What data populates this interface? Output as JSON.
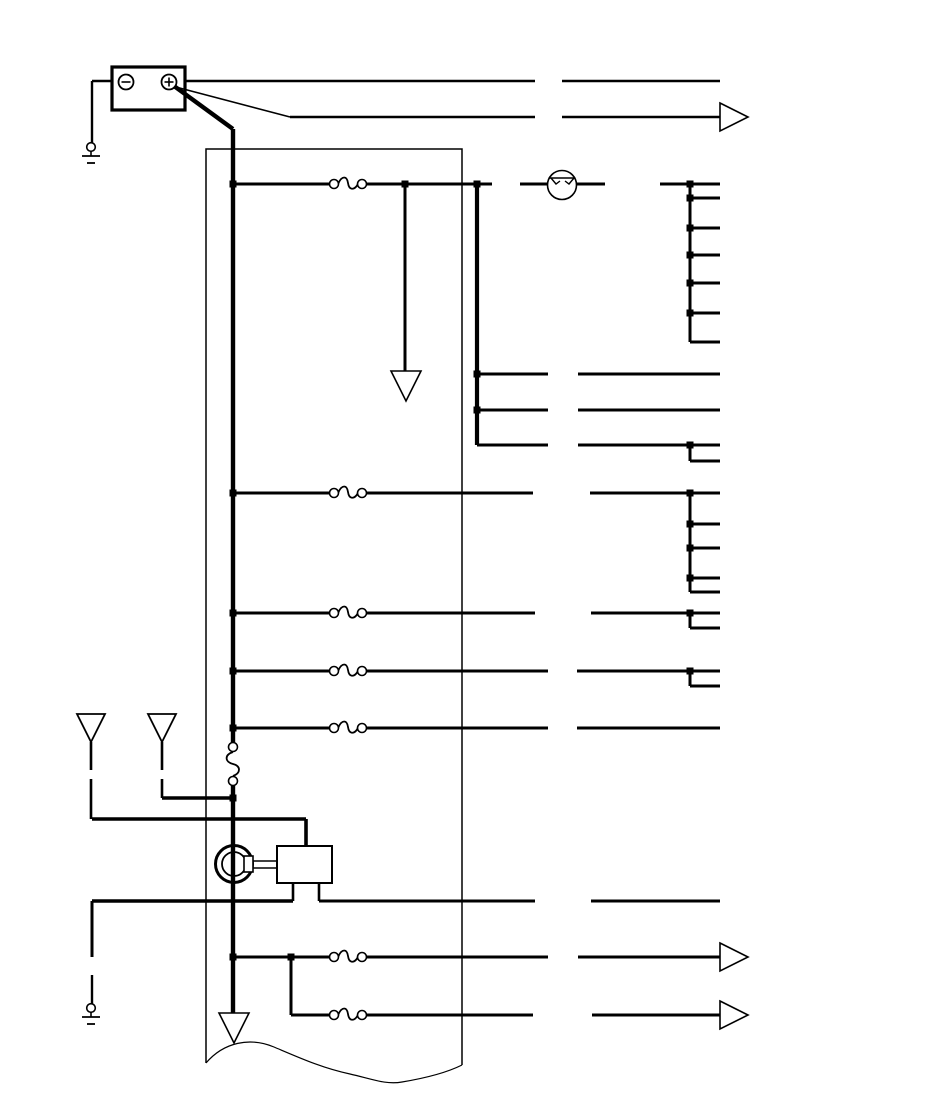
{
  "diagram": {
    "kind": "automotive-wiring-schematic",
    "canvas": {
      "width": 950,
      "height": 1108,
      "background": "#ffffff",
      "ink": "#000000"
    },
    "wires": [
      [
        112,
        81,
        92,
        81,
        2.4
      ],
      [
        92,
        81,
        92,
        143,
        2.4
      ],
      [
        185,
        81,
        535,
        81,
        2.4
      ],
      [
        562,
        81,
        720,
        81,
        2.4
      ],
      [
        172,
        86,
        290,
        117,
        1.6
      ],
      [
        290,
        117,
        535,
        117,
        2.4
      ],
      [
        562,
        117,
        720,
        117,
        2.4
      ],
      [
        174,
        86,
        233,
        129,
        4.4
      ],
      [
        233,
        129,
        233,
        743,
        4.4
      ],
      [
        233,
        785,
        233,
        1014,
        4.4
      ],
      [
        233,
        184,
        329,
        184,
        3
      ],
      [
        367,
        184,
        492,
        184,
        3
      ],
      [
        520,
        184,
        548,
        184,
        3
      ],
      [
        577,
        184,
        605,
        184,
        3
      ],
      [
        660,
        184,
        720,
        184,
        3
      ],
      [
        405,
        184,
        405,
        371,
        3
      ],
      [
        477,
        184,
        477,
        445,
        4.2
      ],
      [
        477,
        374,
        548,
        374,
        3
      ],
      [
        578,
        374,
        720,
        374,
        3
      ],
      [
        477,
        410,
        548,
        410,
        3
      ],
      [
        578,
        410,
        720,
        410,
        3
      ],
      [
        477,
        445,
        548,
        445,
        3
      ],
      [
        578,
        445,
        720,
        445,
        3
      ],
      [
        690,
        445,
        690,
        461,
        3
      ],
      [
        690,
        461,
        720,
        461,
        3
      ],
      [
        690,
        184,
        690,
        342,
        3
      ],
      [
        690,
        198,
        720,
        198,
        3
      ],
      [
        690,
        228,
        720,
        228,
        3
      ],
      [
        690,
        255,
        720,
        255,
        3
      ],
      [
        690,
        283,
        720,
        283,
        3
      ],
      [
        690,
        313,
        720,
        313,
        3
      ],
      [
        690,
        342,
        720,
        342,
        3
      ],
      [
        233,
        493,
        329,
        493,
        3
      ],
      [
        367,
        493,
        533,
        493,
        3
      ],
      [
        590,
        493,
        720,
        493,
        3
      ],
      [
        690,
        493,
        690,
        592,
        3
      ],
      [
        690,
        524,
        720,
        524,
        3
      ],
      [
        690,
        548,
        720,
        548,
        3
      ],
      [
        690,
        578,
        720,
        578,
        3
      ],
      [
        690,
        592,
        720,
        592,
        3
      ],
      [
        233,
        613,
        329,
        613,
        3
      ],
      [
        367,
        613,
        535,
        613,
        3
      ],
      [
        591,
        613,
        720,
        613,
        3
      ],
      [
        690,
        613,
        690,
        628,
        3
      ],
      [
        690,
        628,
        720,
        628,
        3
      ],
      [
        233,
        671,
        329,
        671,
        3
      ],
      [
        367,
        671,
        548,
        671,
        3
      ],
      [
        577,
        671,
        720,
        671,
        3
      ],
      [
        690,
        671,
        690,
        686,
        3
      ],
      [
        690,
        686,
        720,
        686,
        3
      ],
      [
        233,
        728,
        329,
        728,
        3
      ],
      [
        367,
        728,
        548,
        728,
        3
      ],
      [
        577,
        728,
        720,
        728,
        3
      ],
      [
        91,
        742,
        91,
        770,
        2.6
      ],
      [
        91,
        779,
        91,
        819,
        2.6
      ],
      [
        92,
        819,
        306,
        819,
        3.6
      ],
      [
        306,
        819,
        306,
        847,
        3.6
      ],
      [
        162,
        742,
        162,
        770,
        2.6
      ],
      [
        162,
        779,
        162,
        798,
        2.6
      ],
      [
        162,
        798,
        233,
        798,
        3.6
      ],
      [
        293,
        883,
        293,
        901,
        2.6
      ],
      [
        319,
        883,
        319,
        901,
        2.6
      ],
      [
        92,
        901,
        293,
        901,
        3.6
      ],
      [
        319,
        901,
        535,
        901,
        3
      ],
      [
        591,
        901,
        720,
        901,
        3
      ],
      [
        92,
        901,
        92,
        957,
        3
      ],
      [
        92,
        975,
        92,
        1004,
        2.4
      ],
      [
        233,
        957,
        329,
        957,
        3
      ],
      [
        367,
        957,
        548,
        957,
        3
      ],
      [
        578,
        957,
        720,
        957,
        3
      ],
      [
        291,
        957,
        291,
        1015,
        3
      ],
      [
        291,
        1015,
        329,
        1015,
        3
      ],
      [
        367,
        1015,
        533,
        1015,
        3
      ],
      [
        592,
        1015,
        720,
        1015,
        3
      ]
    ],
    "junction_dots": {
      "size": 7,
      "points": [
        [
          233,
          184
        ],
        [
          405,
          184
        ],
        [
          477,
          184
        ],
        [
          690,
          184
        ],
        [
          690,
          198
        ],
        [
          690,
          228
        ],
        [
          690,
          255
        ],
        [
          690,
          283
        ],
        [
          690,
          313
        ],
        [
          477,
          374
        ],
        [
          477,
          410
        ],
        [
          690,
          445
        ],
        [
          233,
          493
        ],
        [
          690,
          493
        ],
        [
          690,
          524
        ],
        [
          690,
          548
        ],
        [
          690,
          578
        ],
        [
          233,
          613
        ],
        [
          690,
          613
        ],
        [
          233,
          671
        ],
        [
          690,
          671
        ],
        [
          233,
          728
        ],
        [
          233,
          798
        ],
        [
          233,
          957
        ],
        [
          291,
          957
        ]
      ]
    },
    "fuses": {
      "horizontal": [
        [
          348,
          184
        ],
        [
          348,
          493
        ],
        [
          348,
          613
        ],
        [
          348,
          671
        ],
        [
          348,
          728
        ],
        [
          348,
          957
        ],
        [
          348,
          1015
        ]
      ],
      "vertical": [
        [
          233,
          764
        ]
      ]
    },
    "right_arrows": [
      [
        720,
        117
      ],
      [
        720,
        957
      ],
      [
        720,
        1015
      ]
    ],
    "down_arrows": [
      [
        406,
        371
      ],
      [
        234,
        1013
      ]
    ],
    "connector_triangles": [
      [
        91,
        714
      ],
      [
        162,
        714
      ]
    ],
    "circuit_breaker": {
      "cx": 562,
      "cy": 185,
      "r": 14.5
    },
    "battery": {
      "x": 112,
      "y": 67,
      "w": 73,
      "h": 43,
      "neg": [
        126,
        82
      ],
      "pos": [
        169,
        82
      ],
      "term_r": 7.5
    },
    "grounds": [
      [
        91,
        147
      ],
      [
        91,
        1008
      ]
    ],
    "motor": {
      "cx": 234,
      "cy": 864,
      "r_outer": 18.5,
      "r_inner": 12,
      "tab": [
        244,
        856,
        9,
        16
      ],
      "shaft_x": [
        253,
        277
      ],
      "shaft_y": [
        861,
        868
      ],
      "box": [
        277,
        846,
        55,
        37
      ]
    },
    "partial_box": {
      "left_x": 206,
      "right_x": 462,
      "top_y": 149,
      "left_bottom_y": 1063,
      "right_bottom_y": 1065,
      "break_path": "M206,1063 C224,1042 250,1037 274,1047 C300,1058 322,1068 350,1074 C372,1079 386,1085 402,1082 C426,1078 448,1072 462,1065"
    }
  }
}
